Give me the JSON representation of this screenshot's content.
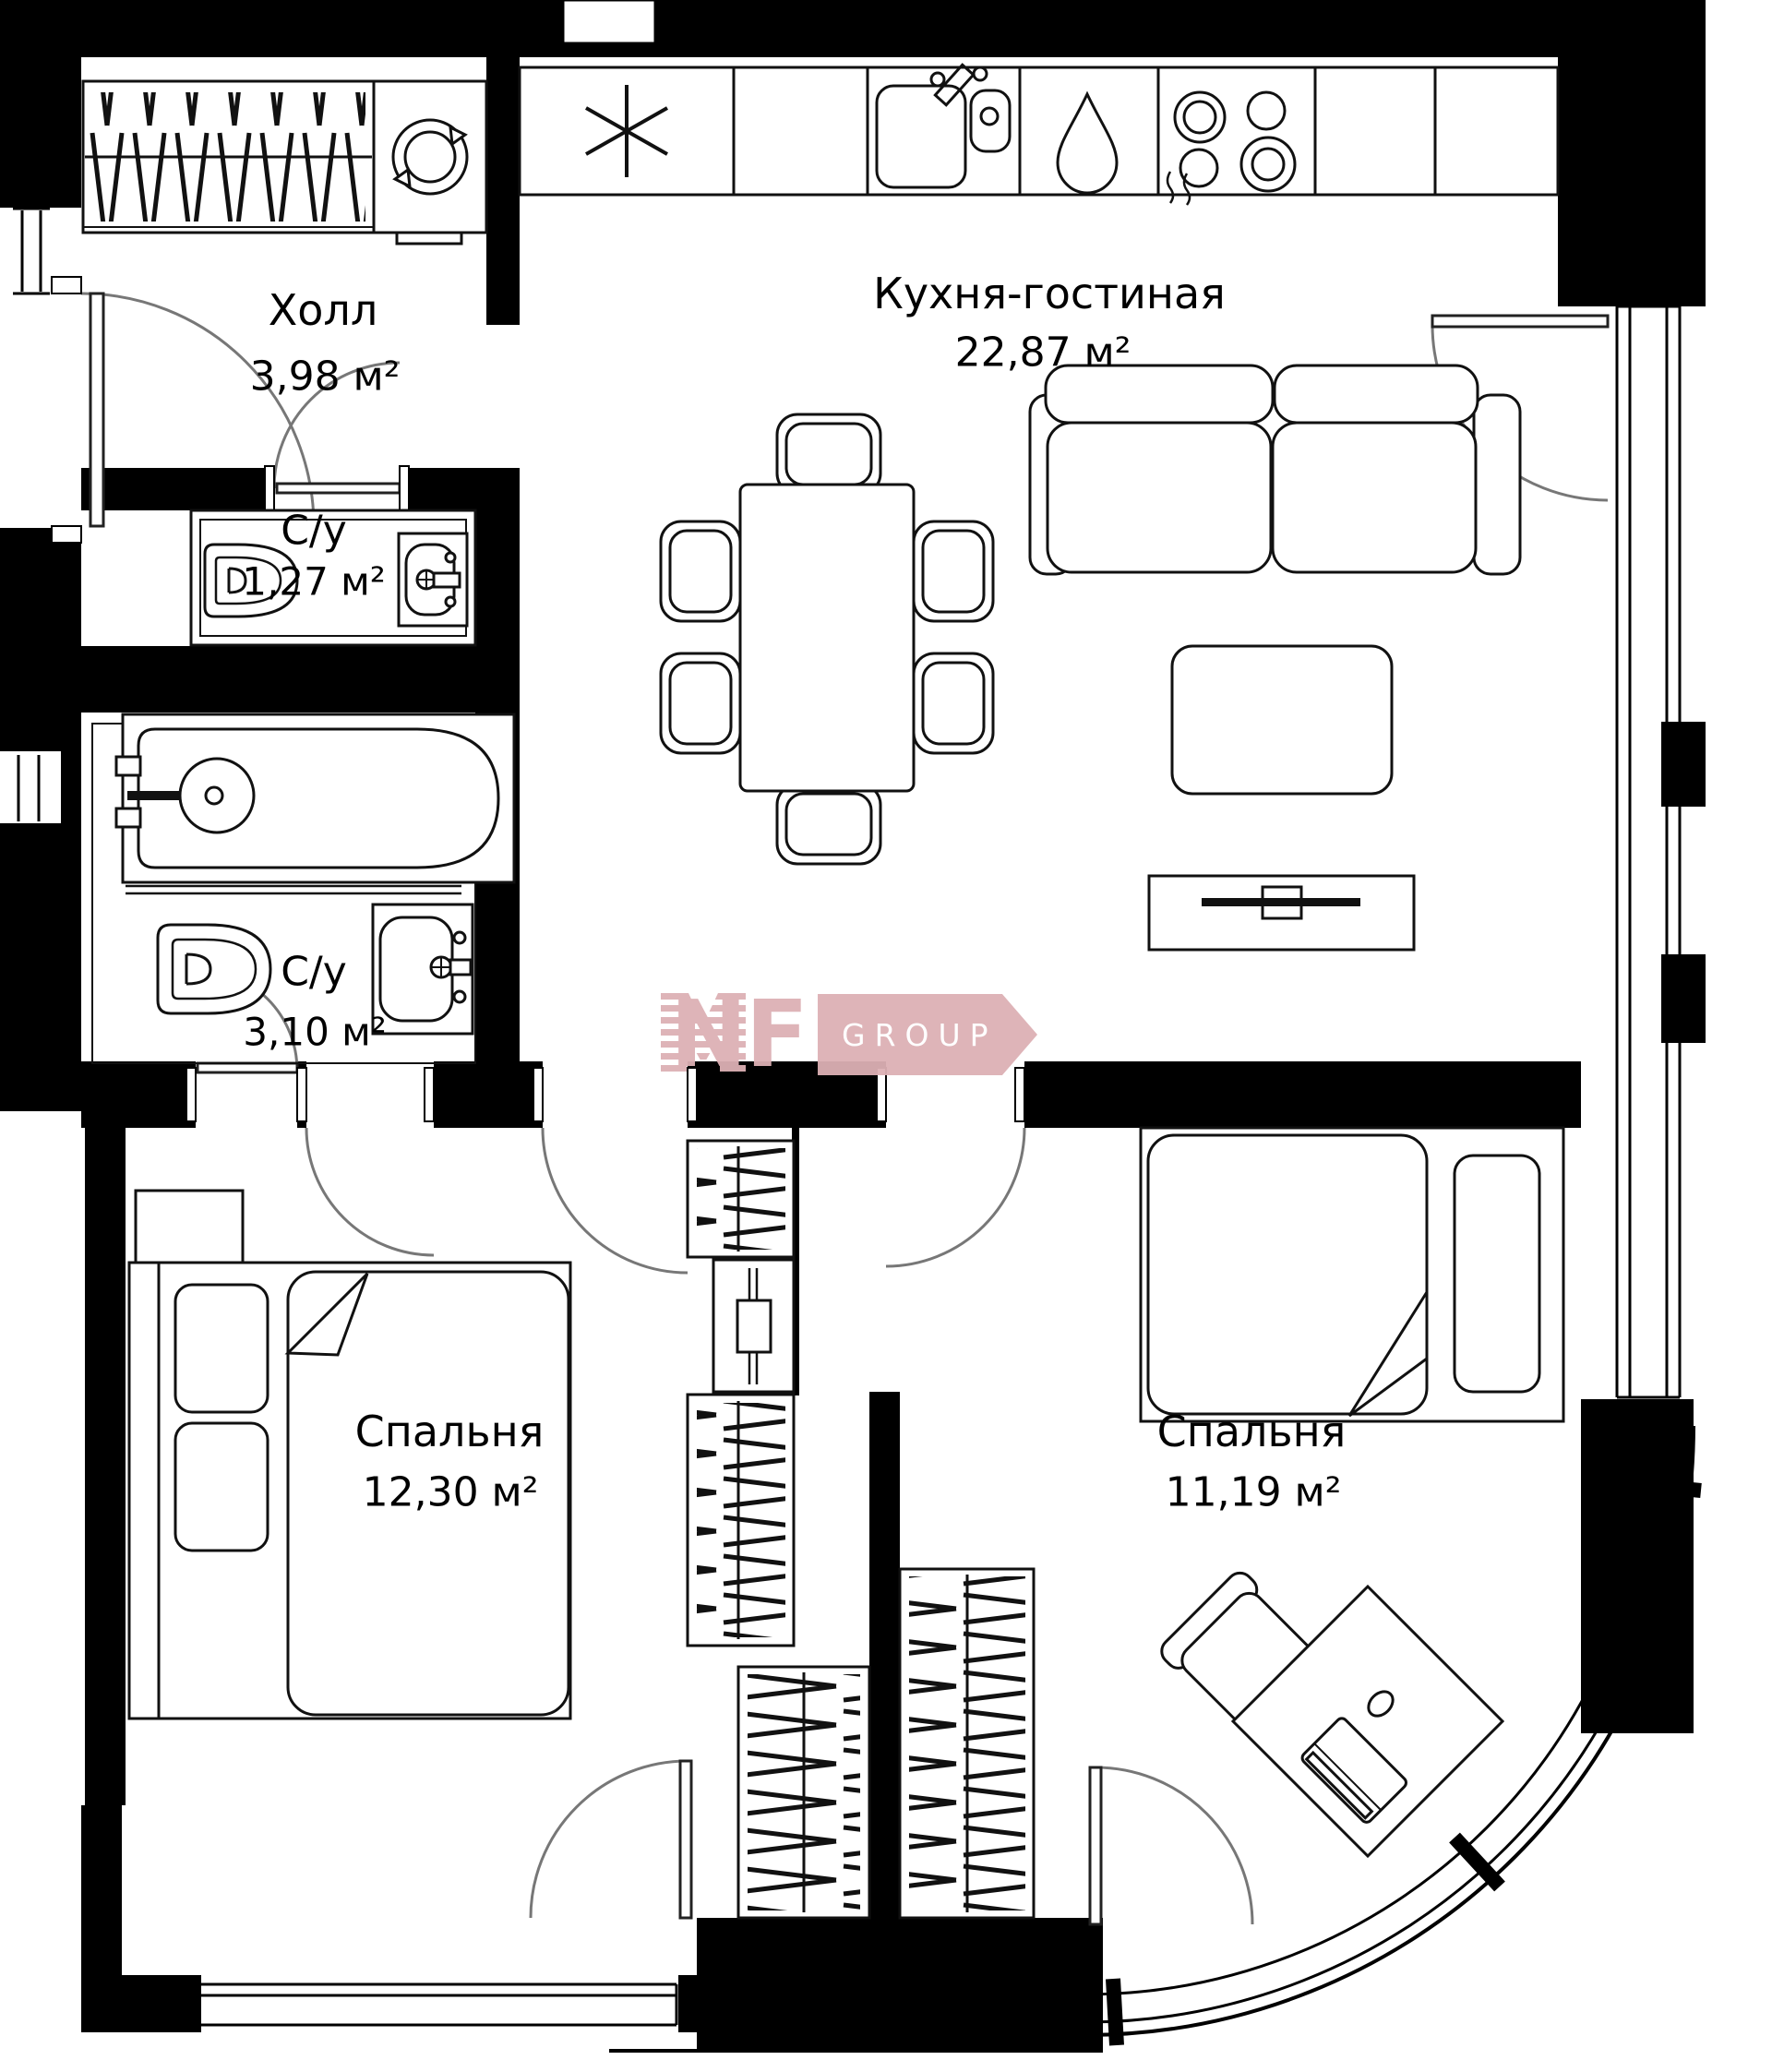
{
  "plan": {
    "title": "apartment-floor-plan",
    "rooms": [
      {
        "id": "hall",
        "name": "Холл",
        "area": "3,98 м²"
      },
      {
        "id": "wc-small",
        "name": "С/у",
        "area": "1,27 м²"
      },
      {
        "id": "bathroom",
        "name": "С/у",
        "area": "3,10 м²"
      },
      {
        "id": "kitchen-living",
        "name": "Кухня-гостиная",
        "area": "22,87 м²"
      },
      {
        "id": "bedroom-1",
        "name": "Спальня",
        "area": "12,30 м²"
      },
      {
        "id": "bedroom-2",
        "name": "Спальня",
        "area": "11,19 м²"
      }
    ],
    "watermark": {
      "brand": "NF",
      "suffix": "GROUP"
    },
    "colors": {
      "walls": "#000000",
      "furniture_lines": "#111111",
      "door_arcs": "#777777",
      "logo_pink": "#ddb0b5",
      "background": "#ffffff"
    },
    "icons": [
      "wardrobe-hangers-icon",
      "washing-machine-icon",
      "snowflake-icon",
      "kitchen-sink-icon",
      "water-drop-icon",
      "cooktop-icon",
      "toilet-icon",
      "washbasin-icon",
      "bathtub-icon",
      "dining-table-icon",
      "sofa-icon",
      "coffee-table-icon",
      "tv-stand-icon",
      "bed-icon",
      "desk-icon",
      "chair-icon",
      "laptop-icon",
      "mirror-dresser-icon"
    ]
  }
}
